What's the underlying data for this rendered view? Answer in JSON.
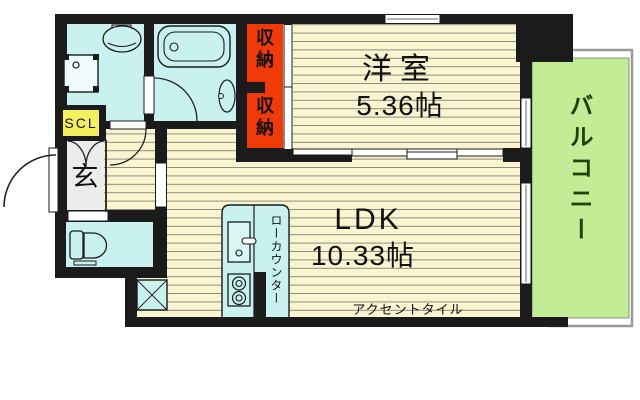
{
  "rooms": {
    "western": {
      "label": "洋室",
      "size": "5.36帖"
    },
    "ldk": {
      "label": "LDK",
      "size": "10.33帖"
    },
    "balcony": {
      "label": "バルコニー"
    },
    "entrance": {
      "label": "玄"
    },
    "shoe_closet": {
      "label": "SCL"
    },
    "storage_upper": {
      "label": "収納"
    },
    "storage_lower": {
      "label": "収納"
    }
  },
  "annotations": {
    "low_counter": "ローカウンター",
    "accent_tile": "アクセントタイル"
  },
  "icons": [
    "bathtub-icon",
    "washbasin-icon",
    "washing-machine-icon",
    "toilet-icon",
    "kitchen-sink-icon",
    "stove-icon",
    "refrigerator-space-icon",
    "door-swing-icon",
    "window-icon"
  ],
  "colors": {
    "wall": "#1b1b1b",
    "floor": "#faf5d1",
    "floor_stripe": "#8f8d7e",
    "wet_area": "#c9f1ef",
    "storage_red": "#f13a06",
    "balcony_green": "#c3ec96",
    "balcony_text": "#1d4206",
    "shoe_closet_yellow": "#f4ef5f",
    "entrance_tile_gray": "#ececec",
    "balcony_outline_gray": "#9a9a9a"
  }
}
